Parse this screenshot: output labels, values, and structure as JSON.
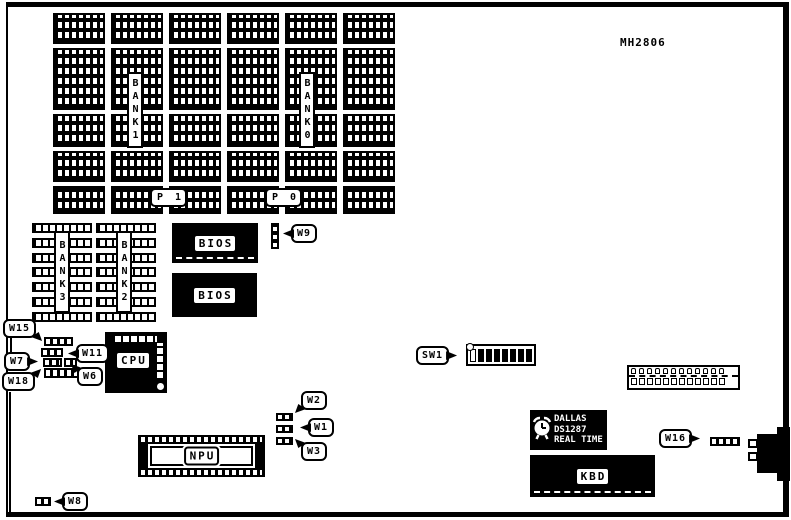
{
  "board": {
    "part_number": "MH2806"
  },
  "memory": {
    "bank0": "BANK0",
    "bank1": "BANK1",
    "bank2": "BANK2",
    "bank3": "BANK3",
    "p0": "P 0",
    "p1": "P 1"
  },
  "chips": {
    "bios1": "BIOS",
    "bios2": "BIOS",
    "cpu": "CPU",
    "npu": "NPU",
    "kbd": "KBD",
    "rtc": {
      "brand": "DALLAS",
      "model": "DS1287",
      "type": "REAL TIME"
    }
  },
  "jumpers": {
    "w1": "W1",
    "w2": "W2",
    "w3": "W3",
    "w6": "W6",
    "w7": "W7",
    "w8": "W8",
    "w9": "W9",
    "w11": "W11",
    "w15": "W15",
    "w16": "W16",
    "w18": "W18"
  },
  "dip_switch": {
    "label": "SW1",
    "positions": 8
  },
  "slots": {
    "left_column_count": 6,
    "right_column_count": 8
  },
  "colors": {
    "ink": "#000000",
    "paper": "#ffffff"
  }
}
